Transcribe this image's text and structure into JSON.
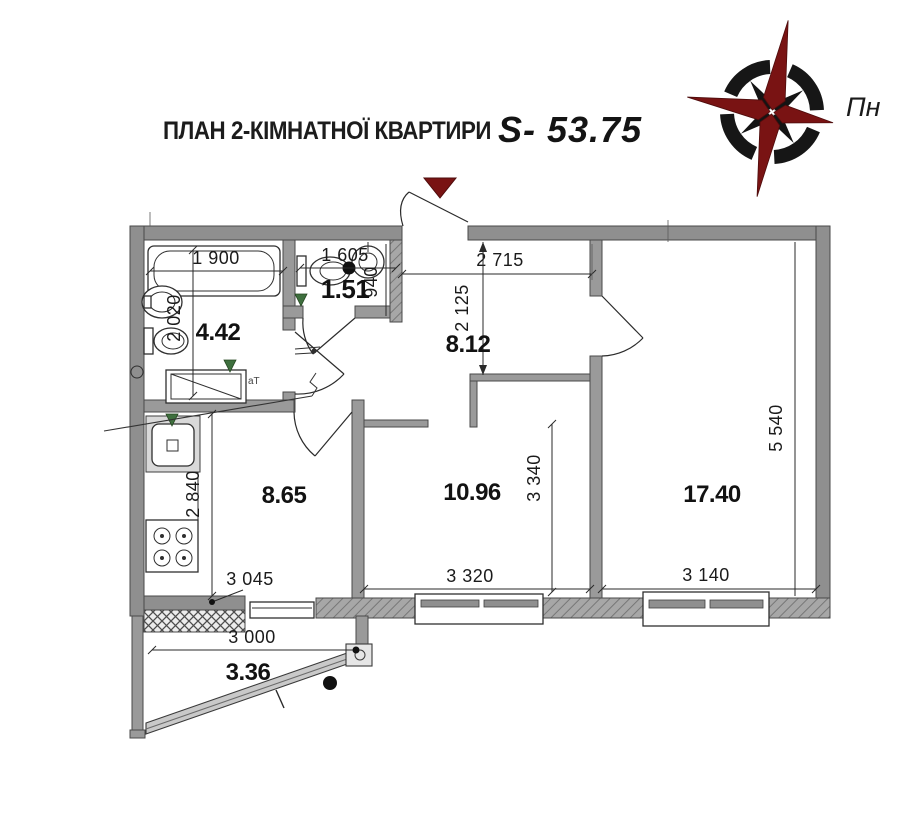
{
  "header": {
    "title": "ПЛАН 2-КІМНАТНОЇ КВАРТИРИ",
    "area_value": "S- 53.75"
  },
  "compass": {
    "north_label": "Пн",
    "star_color": "#791313",
    "ring_color": "#161616"
  },
  "rooms": [
    {
      "key": "bathroom",
      "area": "4.42"
    },
    {
      "key": "wc",
      "area": "1.51"
    },
    {
      "key": "hall",
      "area": "8.12"
    },
    {
      "key": "kitchen",
      "area": "8.65"
    },
    {
      "key": "living-room",
      "area": "10.96"
    },
    {
      "key": "bedroom",
      "area": "17.40"
    },
    {
      "key": "balcony",
      "area": "3.36"
    }
  ],
  "dimensions": {
    "bathroom_width": "1 900",
    "wc_width": "1 605",
    "hall_width": "2 715",
    "bathroom_depth": "2 020",
    "wc_depth": "940",
    "hall_depth": "2 125",
    "bedroom_depth": "5 540",
    "living_room_depth": "3 340",
    "kitchen_depth": "2 840",
    "kitchen_width": "3 045",
    "living_room_width": "3 320",
    "bedroom_width": "3 140",
    "balcony_width": "3 000"
  },
  "annotations": {
    "bath_note": "аТ"
  },
  "colors": {
    "wall_gray": "#8f8f8f",
    "accent_maroon": "#791313",
    "line_black": "#2a2a2a"
  }
}
